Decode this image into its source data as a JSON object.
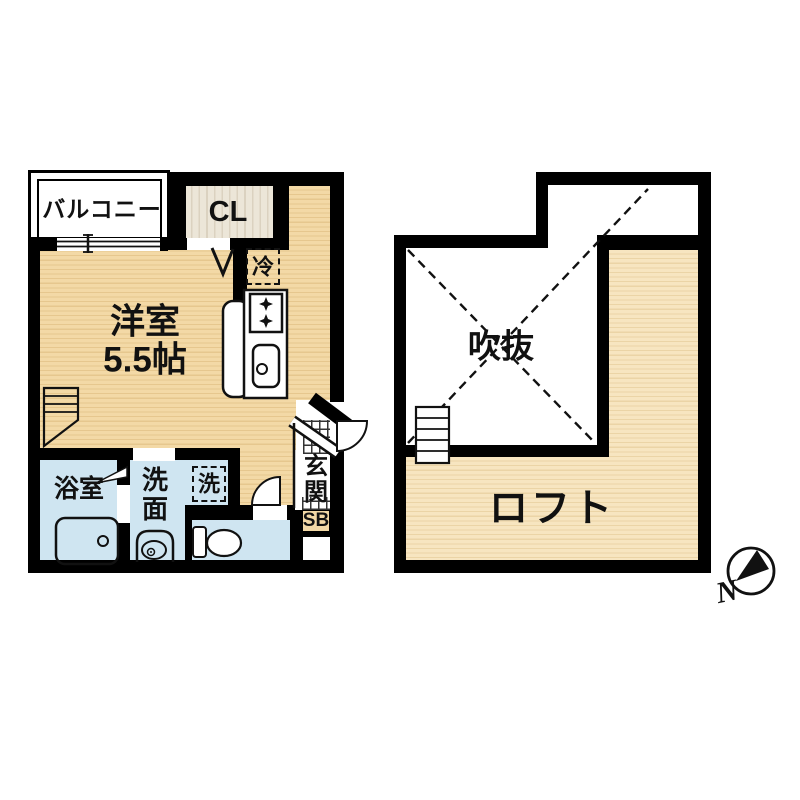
{
  "first_floor": {
    "balcony_label": "バルコニー",
    "closet_label": "CL",
    "refrigerator_label": "冷",
    "room_label": "洋室",
    "room_size_label": "5.5帖",
    "bath_label": "浴室",
    "washroom_label": "洗面",
    "washer_label": "洗",
    "entrance_label": "玄関",
    "shoebox_label": "SB"
  },
  "loft_floor": {
    "void_label": "吹抜",
    "loft_label": "ロフト"
  },
  "compass": {
    "north_label": "N"
  },
  "colors": {
    "wall": "#000000",
    "wood_floor": "#f2d8a4",
    "loft_floor": "#f6e3bd",
    "wet_area_blue": "#cfe5f1",
    "closet_cream": "#ece6d8",
    "shoebox_tan": "#f2d8a6"
  }
}
